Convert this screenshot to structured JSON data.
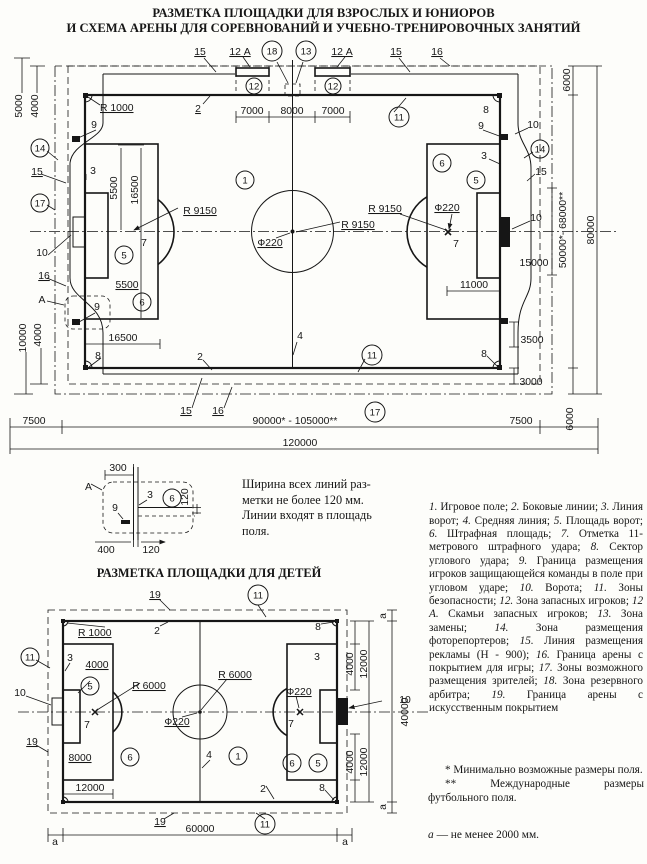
{
  "page": {
    "title_line1": "РАЗМЕТКА ПЛОЩАДКИ ДЛЯ ВЗРОСЛЫХ И ЮНИОРОВ",
    "title_line2": "И СХЕМА АРЕНЫ ДЛЯ СОРЕВНОВАНИЙ И УЧЕБНО-ТРЕНИРОВОЧНЫХ ЗАНЯТИЙ",
    "child_title": "РАЗМЕТКА ПЛОЩАДКИ ДЛЯ ДЕТЕЙ"
  },
  "labels": {
    "n1": "1",
    "n2": "2",
    "n3": "3",
    "n4": "4",
    "n5": "5",
    "n6": "6",
    "n7": "7",
    "n8": "8",
    "n9": "9",
    "n10": "10",
    "n11": "11",
    "n12": "12",
    "n12a": "12 А",
    "n13": "13",
    "n14": "14",
    "n15": "15",
    "n16": "16",
    "n17": "17",
    "n18": "18",
    "n19": "19",
    "aU": "А",
    "aL": "а"
  },
  "dims": {
    "d300": "300",
    "d400": "400",
    "d120": "120",
    "d7000": "7000",
    "d8000": "8000",
    "d5000": "5000",
    "d4000": "4000",
    "d5500": "5500",
    "d16500": "16500",
    "d10000": "10000",
    "d15000": "15000",
    "d11000": "11000",
    "d3500": "3500",
    "d3000": "3000",
    "d6000": "6000",
    "d7500": "7500",
    "d12000": "12000",
    "d40000": "40000",
    "d60000": "60000",
    "d90000_105000": "90000* - 105000**",
    "d120000": "120000",
    "d50000_68000": "50000*- 68000**",
    "d80000": "80000",
    "r1000": "R 1000",
    "r9150": "R 9150",
    "r6000": "R 6000",
    "f220": "Ф220"
  },
  "note": {
    "l1": "Ширина всех линий раз-",
    "l2": "метки не более 120 мм.",
    "l3": "Линии входят в площадь",
    "l4": "поля."
  },
  "legend": {
    "items": [
      {
        "num": "1.",
        "text": "Игровое поле;"
      },
      {
        "num": "2.",
        "text": "Боковые линии;"
      },
      {
        "num": "3.",
        "text": "Линия ворот;"
      },
      {
        "num": "4.",
        "text": "Средняя линия;"
      },
      {
        "num": "5.",
        "text": "Площадь ворот;"
      },
      {
        "num": "6.",
        "text": "Штрафная площадь;"
      },
      {
        "num": "7.",
        "text": "Отметка 11-метрового штрафного удара;"
      },
      {
        "num": "8.",
        "text": "Сектор углового удара;"
      },
      {
        "num": "9.",
        "text": "Граница размещения игроков защищающейся команды в поле при угловом ударе;"
      },
      {
        "num": "10.",
        "text": "Ворота;"
      },
      {
        "num": "11.",
        "text": "Зоны безопасности;"
      },
      {
        "num": "12.",
        "text": "Зона запасных игроков;"
      },
      {
        "num": "12 А.",
        "text": "Скамьи запасных игроков;"
      },
      {
        "num": "13.",
        "text": "Зона замены;"
      },
      {
        "num": "14.",
        "text": "Зона размещения фоторепортеров;"
      },
      {
        "num": "15.",
        "text": "Линия размещения рекламы (Н - 900);"
      },
      {
        "num": "16.",
        "text": "Граница арены с покрытием для игры;"
      },
      {
        "num": "17.",
        "text": "Зоны возможного размещения зрителей;"
      },
      {
        "num": "18.",
        "text": "Зона резервного арбитра;"
      },
      {
        "num": "19.",
        "text": "Граница арены с искусственным покрытием"
      }
    ]
  },
  "footnotes": {
    "star1": "*",
    "star1_text": "Минимально возможные размеры поля.",
    "star2": "**",
    "star2_text": "Международные размеры футбольного поля.",
    "a_mark": "а",
    "a_text": "— не менее 2000 мм."
  }
}
